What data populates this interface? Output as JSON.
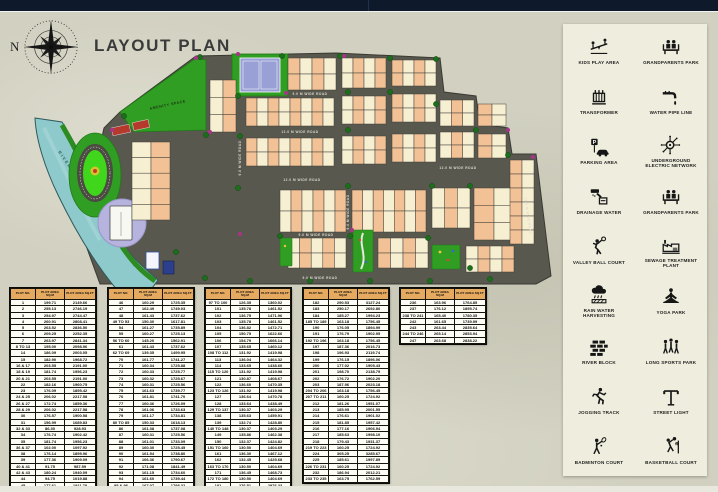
{
  "header": {
    "title": "LAYOUT PLAN",
    "north_label": "N"
  },
  "map": {
    "river_label": "RIVER",
    "amenity_label": "AMENITY SPACE",
    "road_labels": [
      "9.0 M WIDE ROAD",
      "12.0 M WIDE ROAD",
      "12.0 M WIDE ROAD",
      "12.0 M WIDE ROAD",
      "9.0 M WIDE ROAD",
      "9.0 M WIDE ROAD",
      "9.0 M WIDE ROAD",
      "9.0 M WIDE ROAD",
      "12.0 M WIDE ROAD"
    ],
    "colors": {
      "road": "#59584f",
      "plot_peach": "#f2c195",
      "plot_cream": "#f7efd2",
      "plot_border": "#3f3f38",
      "river": "#8ec9cb",
      "park": "#2f9e23",
      "track": "#3fd61b",
      "lavender": "#b6b3de",
      "tree": "#1c6e1c",
      "bush": "#a8348a"
    }
  },
  "tables": {
    "headers": [
      "PLOT NO.",
      "PLOT AREA SQ.M",
      "PLOT AREA SQ.FT"
    ],
    "list": [
      {
        "rows": [
          [
            "1",
            "199.71",
            "2149.66"
          ],
          [
            "2",
            "255.13",
            "2746.19"
          ],
          [
            "3",
            "254.97",
            "2744.47"
          ],
          [
            "4",
            "260.91",
            "2808.41"
          ],
          [
            "5",
            "263.52",
            "2836.50"
          ],
          [
            "6",
            "209.25",
            "2252.35"
          ],
          [
            "7",
            "263.97",
            "2841.34"
          ],
          [
            "8 TO 13",
            "195.00",
            "2098.96"
          ],
          [
            "14",
            "186.09",
            "2003.05"
          ],
          [
            "15",
            "182.90",
            "1968.72"
          ],
          [
            "16 & 17",
            "203.55",
            "2191.00"
          ],
          [
            "18 & 19",
            "181.74",
            "1956.23"
          ],
          [
            "20 & 21",
            "203.55",
            "2191.00"
          ],
          [
            "22",
            "182.16",
            "1960.75"
          ],
          [
            "23",
            "176.09",
            "1895.42"
          ],
          [
            "24 & 25",
            "206.02",
            "2217.58"
          ],
          [
            "26 & 27",
            "172.74",
            "1859.36"
          ],
          [
            "28 & 29",
            "206.02",
            "2217.58"
          ],
          [
            "30",
            "176.57",
            "1900.58"
          ],
          [
            "31",
            "156.99",
            "1689.83"
          ],
          [
            "32 & 33",
            "86.30",
            "928.93"
          ],
          [
            "34",
            "176.74",
            "1902.42"
          ],
          [
            "35",
            "181.74",
            "1956.23"
          ],
          [
            "36 & 37",
            "102.00",
            "1097.92"
          ],
          [
            "38",
            "176.14",
            "1895.96"
          ],
          [
            "39",
            "177.36",
            "1909.09"
          ],
          [
            "40 & 41",
            "91.75",
            "987.59"
          ],
          [
            "42 & 43",
            "180.24",
            "1940.09"
          ],
          [
            "44",
            "94.75",
            "1019.88"
          ],
          [
            "45",
            "177.61",
            "1911.78"
          ]
        ]
      },
      {
        "rows": [
          [
            "46",
            "160.29",
            "1725.35"
          ],
          [
            "47",
            "162.49",
            "1749.03"
          ],
          [
            "48",
            "161.43",
            "1737.62"
          ],
          [
            "49 TO 53",
            "150.30",
            "1617.81"
          ],
          [
            "54",
            "161.27",
            "1735.89"
          ],
          [
            "55",
            "160.27",
            "1725.13"
          ],
          [
            "56 TO 60",
            "145.20",
            "1562.91"
          ],
          [
            "61",
            "161.43",
            "1737.62"
          ],
          [
            "62 TO 69",
            "139.35",
            "1499.95"
          ],
          [
            "70",
            "161.77",
            "1741.27"
          ],
          [
            "71",
            "160.34",
            "1725.88"
          ],
          [
            "72",
            "160.33",
            "1725.77"
          ],
          [
            "73",
            "160.32",
            "1725.67"
          ],
          [
            "74",
            "160.31",
            "1725.56"
          ],
          [
            "75",
            "161.63",
            "1739.77"
          ],
          [
            "76",
            "161.81",
            "1741.70"
          ],
          [
            "77",
            "160.36",
            "1726.09"
          ],
          [
            "78",
            "161.06",
            "1733.63"
          ],
          [
            "79",
            "161.17",
            "1734.81"
          ],
          [
            "80 TO 85",
            "150.33",
            "1618.13"
          ],
          [
            "86",
            "161.38",
            "1737.08"
          ],
          [
            "87",
            "160.31",
            "1725.56"
          ],
          [
            "88",
            "161.01",
            "1733.09"
          ],
          [
            "89",
            "160.30",
            "1725.45"
          ],
          [
            "90",
            "161.54",
            "1738.80"
          ],
          [
            "91",
            "166.36",
            "1790.67"
          ],
          [
            "92",
            "171.08",
            "1841.49"
          ],
          [
            "93",
            "161.15",
            "1734.60"
          ],
          [
            "94",
            "161.60",
            "1739.44"
          ],
          [
            "95 & 96",
            "167.07",
            "1798.32"
          ]
        ]
      },
      {
        "rows": [
          [
            "97 TO 100",
            "126.35",
            "1360.02"
          ],
          [
            "101",
            "135.78",
            "1461.52"
          ],
          [
            "102",
            "136.75",
            "1471.96"
          ],
          [
            "103",
            "135.78",
            "1461.52"
          ],
          [
            "104",
            "136.82",
            "1472.71"
          ],
          [
            "105",
            "150.75",
            "1622.66"
          ],
          [
            "106",
            "154.79",
            "1666.14"
          ],
          [
            "107",
            "135.65",
            "1460.12"
          ],
          [
            "108 TO 112",
            "131.92",
            "1419.98"
          ],
          [
            "113",
            "136.04",
            "1464.32"
          ],
          [
            "114",
            "133.65",
            "1438.60"
          ],
          [
            "115 TO 120",
            "131.92",
            "1419.98"
          ],
          [
            "121",
            "130.87",
            "1408.67"
          ],
          [
            "122",
            "136.60",
            "1470.35"
          ],
          [
            "123 TO 126",
            "131.92",
            "1419.98"
          ],
          [
            "127",
            "136.64",
            "1470.78"
          ],
          [
            "128",
            "133.64",
            "1438.49"
          ],
          [
            "129 TO 137",
            "130.37",
            "1403.29"
          ],
          [
            "138",
            "135.63",
            "1459.91"
          ],
          [
            "139",
            "132.74",
            "1428.80"
          ],
          [
            "140 TO 148",
            "130.37",
            "1403.29"
          ],
          [
            "149",
            "135.86",
            "1462.38"
          ],
          [
            "150",
            "132.37",
            "1424.82"
          ],
          [
            "151 TO 160",
            "130.50",
            "1404.69"
          ],
          [
            "161",
            "136.30",
            "1467.12"
          ],
          [
            "162",
            "132.45",
            "1425.68"
          ],
          [
            "163 TO 170",
            "130.50",
            "1404.69"
          ],
          [
            "171",
            "136.45",
            "1468.73"
          ],
          [
            "172 TO 180",
            "130.50",
            "1404.69"
          ],
          [
            "181",
            "276.51",
            "2976.33"
          ]
        ]
      },
      {
        "rows": [
          [
            "182",
            "290.53",
            "3127.24"
          ],
          [
            "183",
            "250.17",
            "2692.80"
          ],
          [
            "184",
            "185.27",
            "1994.23"
          ],
          [
            "185 TO 189",
            "163.18",
            "1756.45"
          ],
          [
            "190",
            "176.05",
            "1894.99"
          ],
          [
            "191",
            "176.79",
            "1902.95"
          ],
          [
            "192 TO 196",
            "163.18",
            "1756.45"
          ],
          [
            "197",
            "187.36",
            "2016.73"
          ],
          [
            "198",
            "196.93",
            "2119.74"
          ],
          [
            "199",
            "176.15",
            "1896.06"
          ],
          [
            "200",
            "177.02",
            "1905.43"
          ],
          [
            "201",
            "198.70",
            "2138.79"
          ],
          [
            "202",
            "176.72",
            "1902.20"
          ],
          [
            "203",
            "187.96",
            "2023.18"
          ],
          [
            "204 TO 206",
            "163.18",
            "1756.45"
          ],
          [
            "207 TO 211",
            "160.25",
            "1724.92"
          ],
          [
            "212",
            "181.26",
            "1951.07"
          ],
          [
            "213",
            "185.95",
            "2001.55"
          ],
          [
            "214",
            "176.61",
            "1901.02"
          ],
          [
            "215",
            "181.85",
            "1957.42"
          ],
          [
            "216",
            "177.16",
            "1906.94"
          ],
          [
            "217",
            "185.63",
            "1998.10"
          ],
          [
            "218",
            "179.43",
            "1931.37"
          ],
          [
            "219 TO 223",
            "160.25",
            "1724.92"
          ],
          [
            "224",
            "305.25",
            "3285.67"
          ],
          [
            "225",
            "185.61",
            "1997.89"
          ],
          [
            "226 TO 231",
            "160.25",
            "1724.92"
          ],
          [
            "232",
            "186.94",
            "2012.21"
          ],
          [
            "233 TO 235",
            "163.75",
            "1762.59"
          ]
        ]
      },
      {
        "rows": [
          [
            "236",
            "163.96",
            "1764.85"
          ],
          [
            "237",
            "176.12",
            "1895.74"
          ],
          [
            "238 TO 241",
            "165.40",
            "1780.35"
          ],
          [
            "242",
            "161.65",
            "1739.99"
          ],
          [
            "243",
            "263.44",
            "2835.64"
          ],
          [
            "244 TO 246",
            "265.14",
            "2853.94"
          ],
          [
            "247",
            "263.68",
            "2838.22"
          ]
        ]
      }
    ]
  },
  "legend": {
    "items": [
      {
        "icon": "kids-play-area-icon",
        "label": "KIDS PLAY AREA"
      },
      {
        "icon": "grandparents-park-icon",
        "label": "GRANDPARENTS PARK"
      },
      {
        "icon": "transformer-icon",
        "label": "TRANSFORMER"
      },
      {
        "icon": "water-pipe-line-icon",
        "label": "WATER PIPE LINE"
      },
      {
        "icon": "parking-area-icon",
        "label": "PARKING AREA"
      },
      {
        "icon": "underground-electric-network-icon",
        "label": "UNDERGROUND ELECTRIC NETWORK"
      },
      {
        "icon": "drainage-water-icon",
        "label": "DRAINAGE WATER"
      },
      {
        "icon": "grandparents-park-icon",
        "label": "GRANDPARENTS PARK"
      },
      {
        "icon": "volleyball-court-icon",
        "label": "VALLEY BALL COURT"
      },
      {
        "icon": "sewage-treatment-plant-icon",
        "label": "SEWAGE TREATMENT PLANT"
      },
      {
        "icon": "rain-water-harvesting-icon",
        "label": "RAIN WATER HARVESTING"
      },
      {
        "icon": "yoga-park-icon",
        "label": "YOGA PARK"
      },
      {
        "icon": "river-block-icon",
        "label": "RIVER BLOCK"
      },
      {
        "icon": "long-sports-park-icon",
        "label": "LONG SPORTS PARK"
      },
      {
        "icon": "jogging-track-icon",
        "label": "JOGGING TRACK"
      },
      {
        "icon": "street-light-icon",
        "label": "STREET LIGHT"
      },
      {
        "icon": "badminton-court-icon",
        "label": "BADMINTON COURT"
      },
      {
        "icon": "basketball-court-icon",
        "label": "BASKETBALL COURT"
      }
    ]
  }
}
